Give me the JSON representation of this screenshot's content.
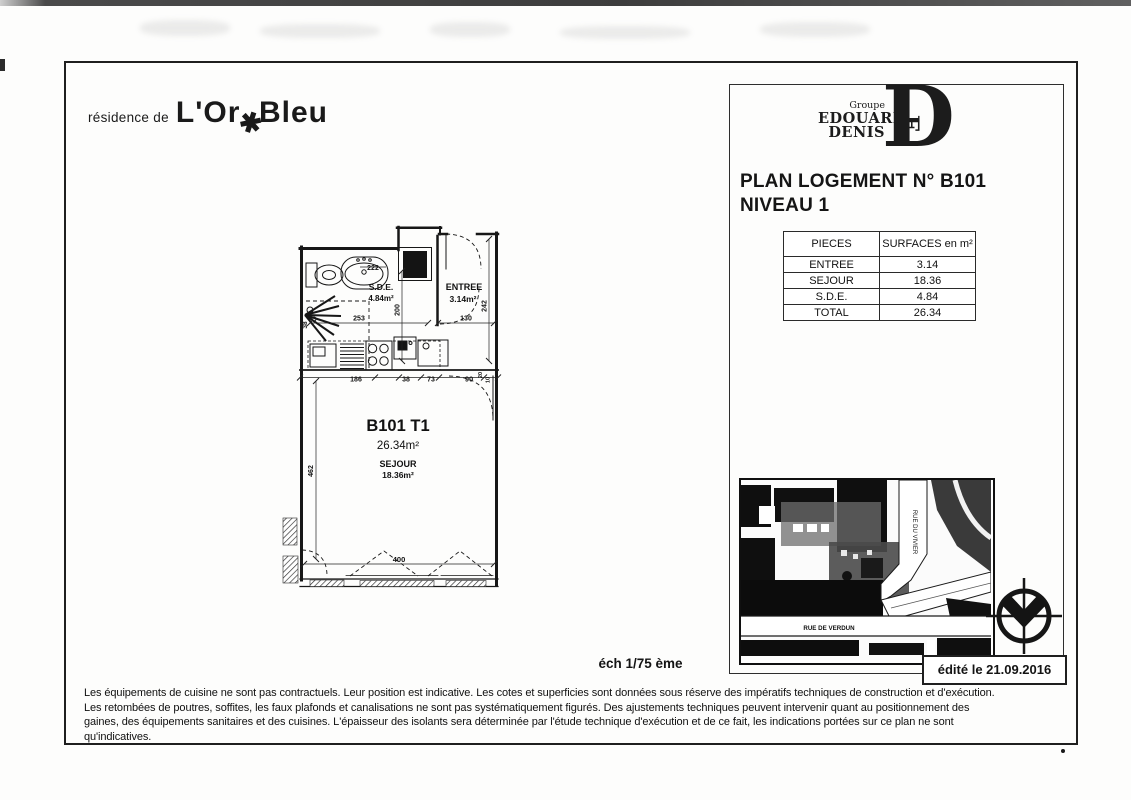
{
  "branding": {
    "residence_prefix": "résidence de",
    "residence_word1": "L'Or",
    "residence_star": "✱",
    "residence_word2": "Bleu",
    "group_label": "Groupe",
    "group_name1": "EDOUARD",
    "group_name2": "DENIS",
    "monogram_letter": "D",
    "monogram_inner": "E"
  },
  "header": {
    "title_line1": "PLAN LOGEMENT N° B101",
    "title_line2": "NIVEAU 1"
  },
  "surfaces_table": {
    "col1": "PIECES",
    "col2": "SURFACES en m²",
    "rows": [
      {
        "piece": "ENTREE",
        "surface": "3.14"
      },
      {
        "piece": "SEJOUR",
        "surface": "18.36"
      },
      {
        "piece": "S.D.E.",
        "surface": "4.84"
      },
      {
        "piece": "TOTAL",
        "surface": "26.34"
      }
    ]
  },
  "floor_plan": {
    "unit": "B101 T1",
    "total_area": "26.34m²",
    "sde_name": "S.D.E.",
    "sde_area": "4.84m²",
    "entree_name": "ENTREE",
    "entree_area": "3.14m²",
    "sejour_name": "SEJOUR",
    "sejour_area": "18.36m²",
    "dims": {
      "d222": "222",
      "d200": "200",
      "d253": "253",
      "d130": "130",
      "d242": "242",
      "d38_left": "38",
      "d186": "186",
      "d38_kitchen": "38",
      "d73": "73",
      "d90": "90",
      "d20": "20",
      "d10": "10",
      "d462": "462",
      "d400": "400"
    }
  },
  "site_map": {
    "street_vertical": "RUE DU VIVIER",
    "street_horizontal": "RUE DE VERDUN"
  },
  "footer": {
    "scale": "éch 1/75 ème",
    "edited": "édité le 21.09.2016",
    "disclaimer_lines": [
      "Les équipements de cuisine ne sont pas contractuels. Leur position est indicative. Les cotes et superficies sont données sous réserve des  impératifs techniques de construction et d'exécution.",
      "Les retombées de poutres, soffites, les faux plafonds et canalisations ne sont pas systématiquement figurés. Des ajustements techniques peuvent intervenir quant au positionnement des",
      "gaines, des équipements sanitaires et des cuisines. L'épaisseur des isolants sera déterminée par l'étude technique d'exécution et de ce fait, les indications portées sur ce plan ne sont",
      "qu'indicatives."
    ]
  }
}
